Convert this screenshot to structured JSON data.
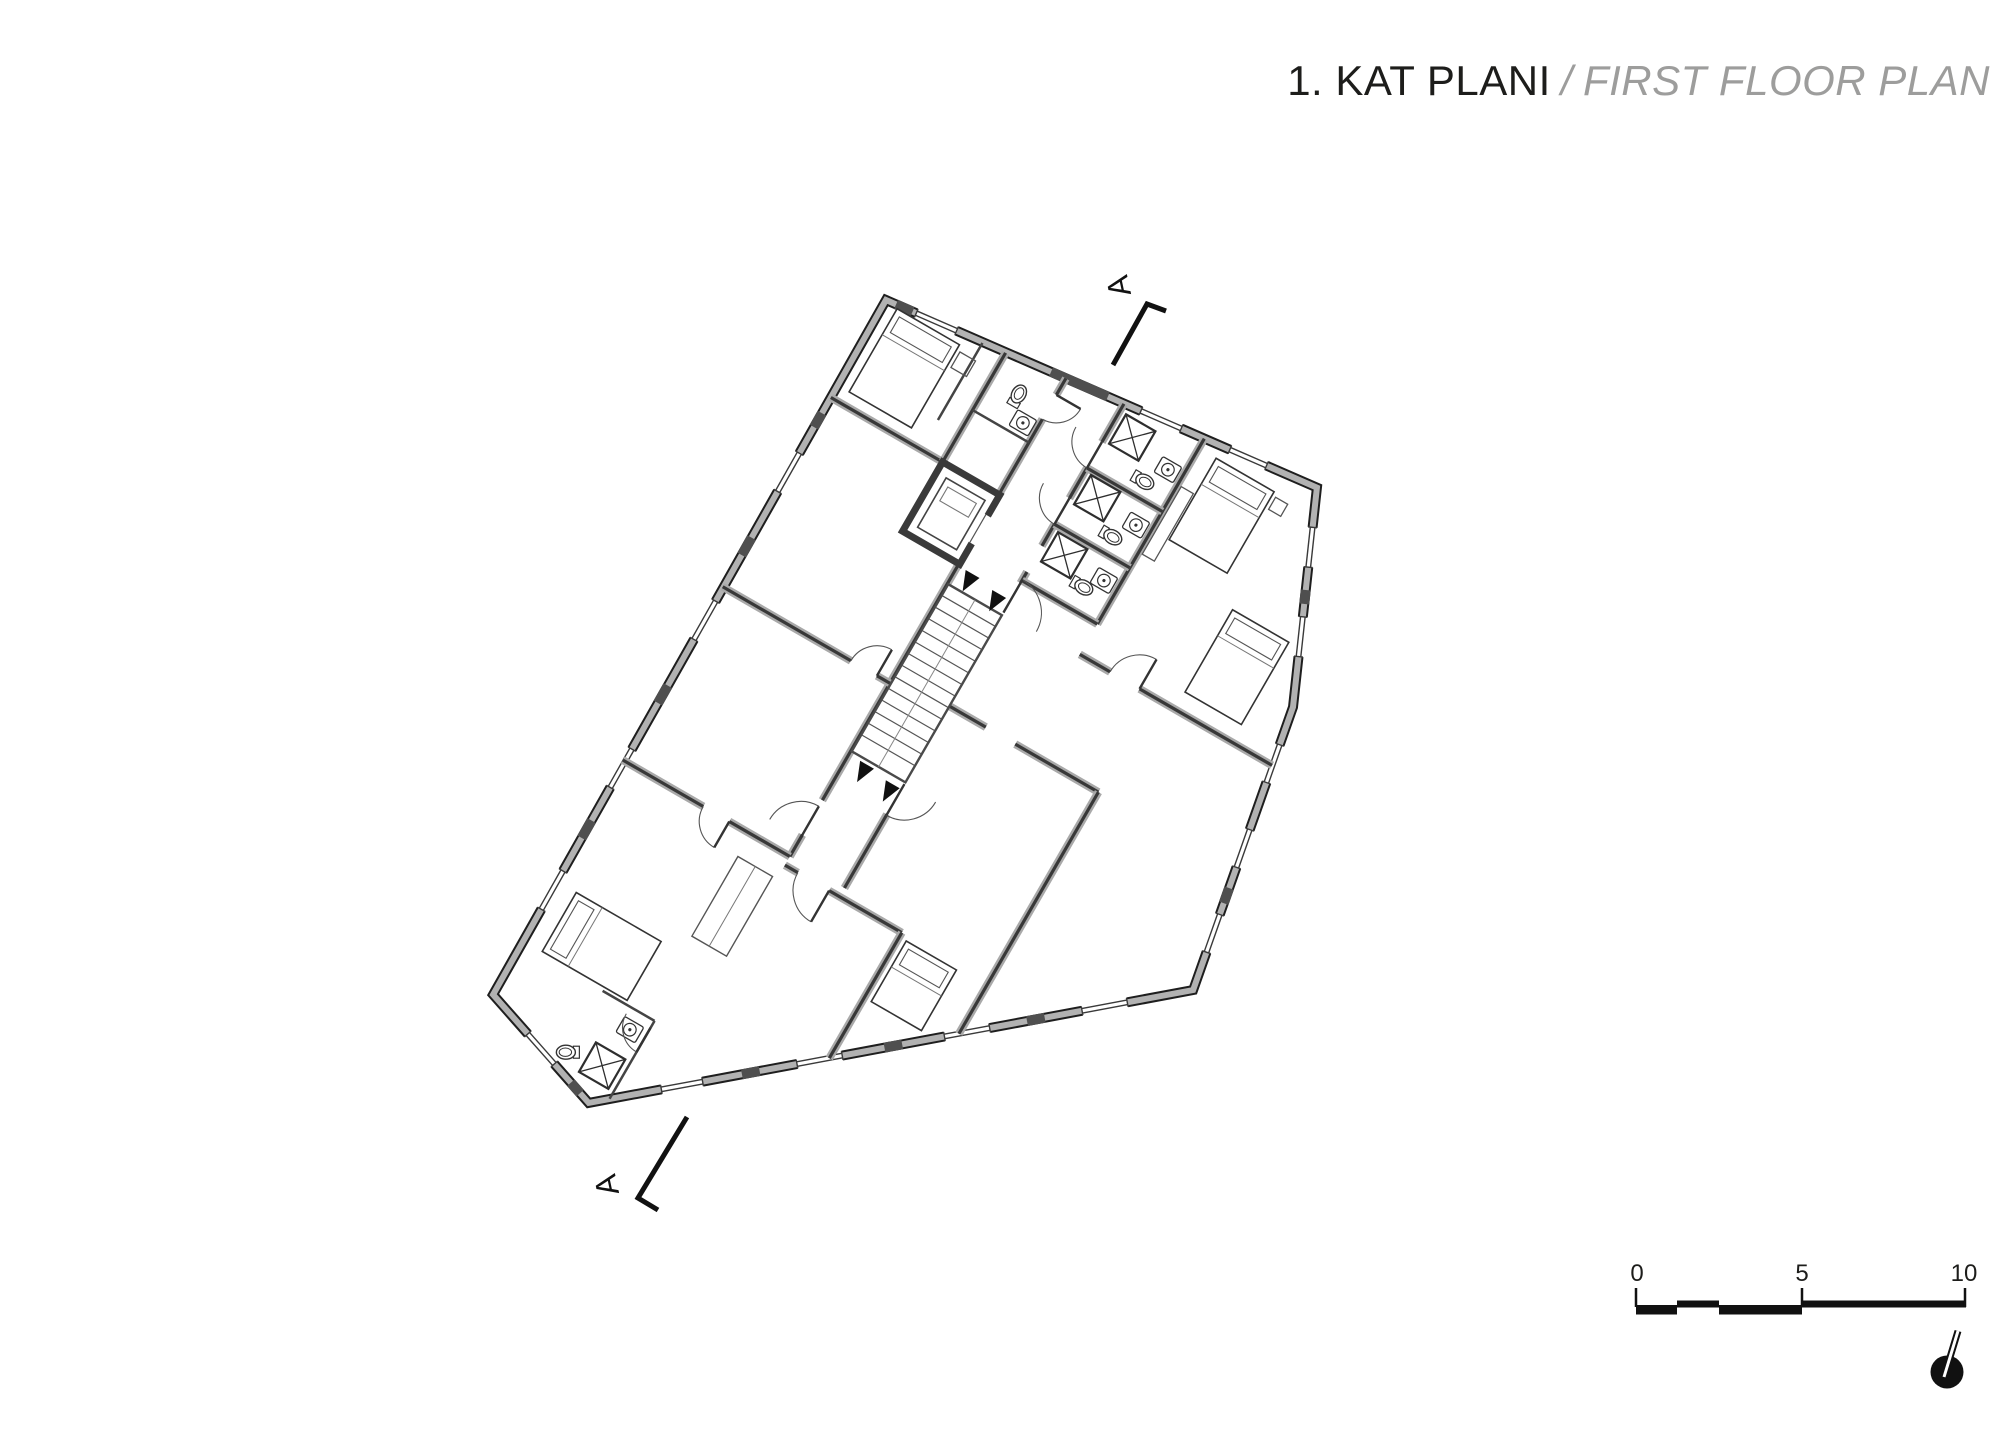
{
  "sheet": {
    "title": {
      "turkish": "1. KAT PLANI",
      "separator": "/",
      "english": "FIRST FLOOR PLAN"
    },
    "section_markers": {
      "top": "A",
      "bottom": "A"
    },
    "scale_bar": {
      "labels": [
        "0",
        "5",
        "10"
      ]
    },
    "colors": {
      "ink": "#1d1d1b",
      "muted_text": "#9d9d9c",
      "wall_fill": "#b2b2b2",
      "pier_fill": "#4f4f4f",
      "paper": "#ffffff"
    }
  }
}
